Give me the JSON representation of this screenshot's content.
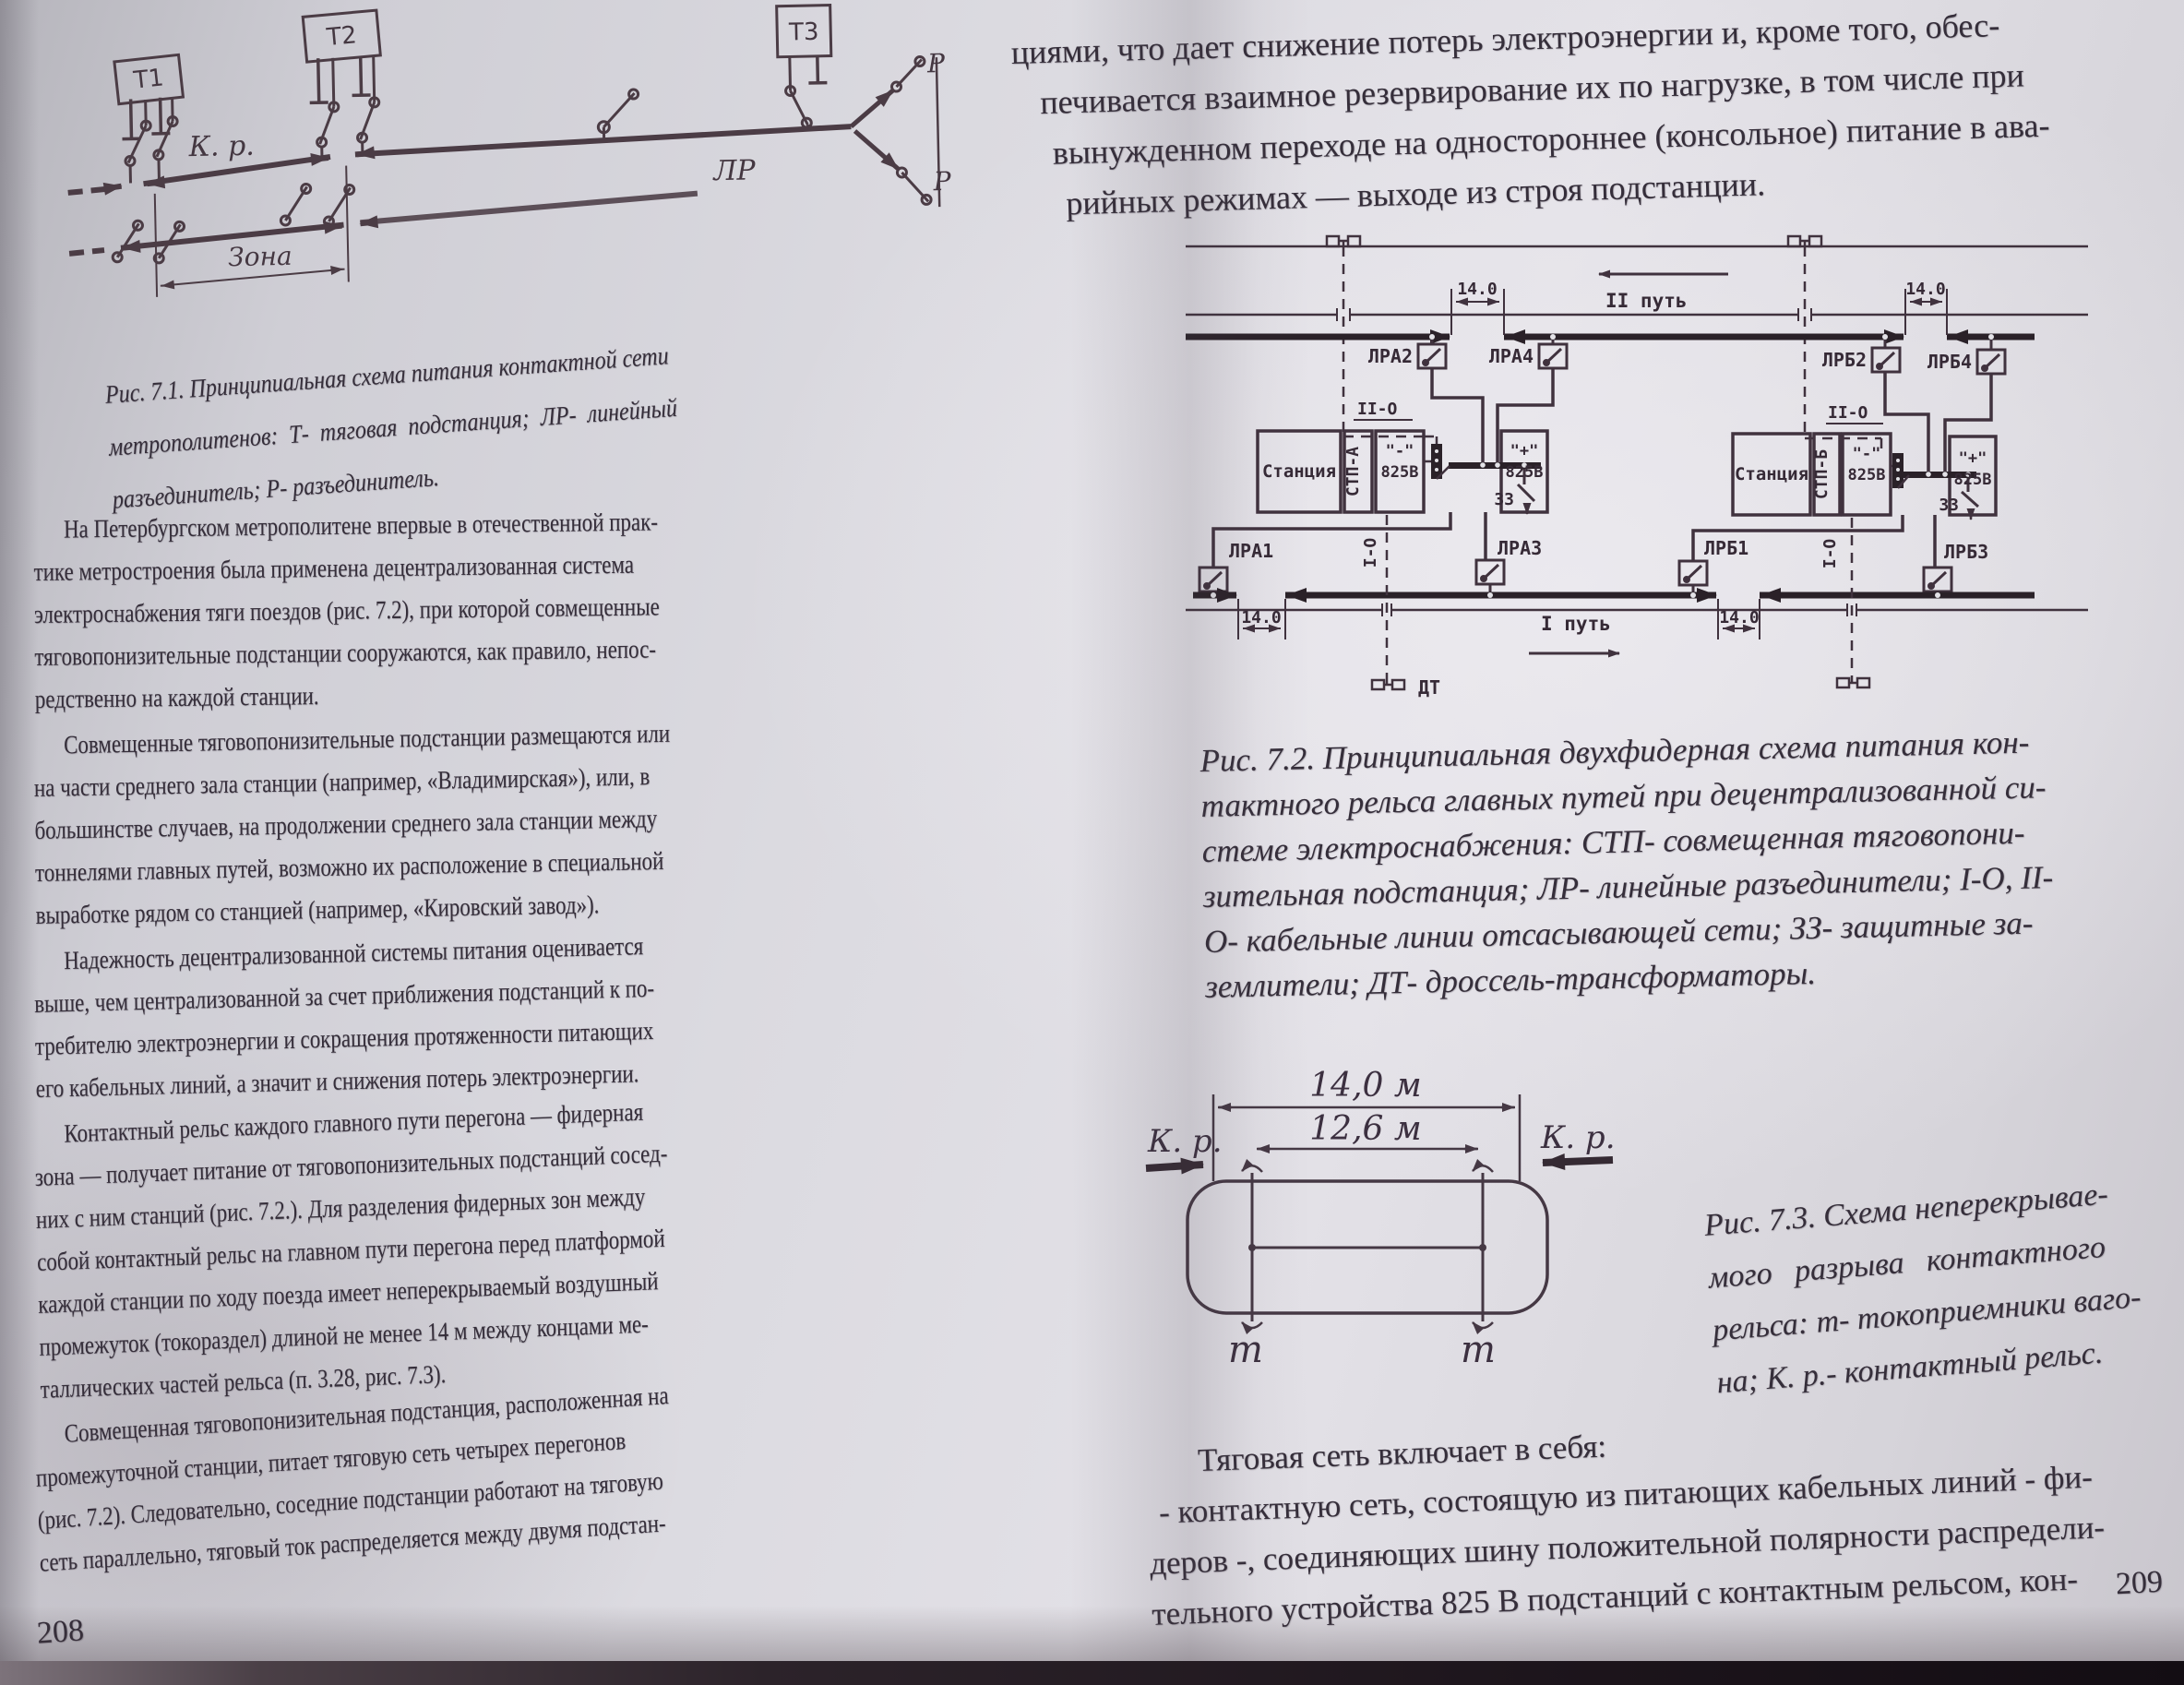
{
  "colors": {
    "paper": "#dbdae0",
    "ink": "#352e3a",
    "figure_ink": "#40323e"
  },
  "book": {
    "left_page": {
      "page_number": "208",
      "fig71": {
        "labels": {
          "t1": "Т1",
          "t2": "Т2",
          "t3": "Т3",
          "kr": "К. р.",
          "lr": "ЛР",
          "r": "Р",
          "zona": "Зона"
        },
        "caption_lines": [
          "Рис. 7.1. Принципиальная схема питания контактной сети",
          "метрополитенов: Т- тяговая подстанция; ЛР- линейный",
          "разъединитель; Р- разъединитель."
        ]
      },
      "paragraphs": [
        {
          "lines": [
            "На Петербургском метрополитене впервые в отечественной прак-",
            "тике метростроения была применена децентрализованная система",
            "электроснабжения тяги поездов (рис. 7.2), при которой совмещенные",
            "тяговопонизительные подстанции сооружаются, как правило, непос-",
            "редственно на каждой станции."
          ]
        },
        {
          "lines": [
            "Совмещенные тяговопонизительные подстанции размещаются или",
            "на части среднего зала станции (например, «Владимирская»), или, в",
            "большинстве случаев, на продолжении среднего зала станции между",
            "тоннелями главных путей, возможно их расположение в специальной",
            "выработке рядом со станцией (например, «Кировский завод»)."
          ]
        },
        {
          "lines": [
            "Надежность децентрализованной системы питания оценивается",
            "выше, чем централизованной за счет приближения подстанций к по-",
            "требителю электроэнергии и сокращения протяженности питающих",
            "его кабельных линий, а значит и снижения потерь электроэнергии."
          ]
        },
        {
          "lines": [
            "Контактный рельс каждого главного пути перегона — фидерная",
            "зона — получает питание от тяговопонизительных подстанций сосед-",
            "них с ним станций (рис. 7.2.). Для разделения фидерных зон между",
            "собой контактный рельс на главном пути перегона перед платформой",
            "каждой станции по ходу поезда имеет неперекрываемый воздушный",
            "промежуток (токораздел) длиной не менее 14 м между концами ме-",
            "таллических частей рельса (п. 3.28, рис. 7.3)."
          ]
        },
        {
          "lines": [
            "Совмещенная тяговопонизительная подстанция, расположенная на",
            "промежуточной станции, питает тяговую сеть четырех перегонов",
            "(рис. 7.2). Следовательно, соседние подстанции работают на тяговую",
            "сеть параллельно, тяговый ток распределяется между двумя подстан-"
          ]
        }
      ]
    },
    "right_page": {
      "page_number": "209",
      "top_paragraph_lines": [
        "циями, что дает снижение потерь электроэнергии и, кроме того, обес-",
        "печивается взаимное резервирование их по нагрузке, в том числе при",
        "вынужденном переходе на одностороннее (консольное) питание в ава-",
        "рийных режимах — выходе из строя подстанции."
      ],
      "fig72": {
        "labels": {
          "track2": "II путь",
          "track1": "I путь",
          "dim": "14.0",
          "lra1": "ЛРА1",
          "lra2": "ЛРА2",
          "lra3": "ЛРА3",
          "lra4": "ЛРА4",
          "lrb1": "ЛРБ1",
          "lrb2": "ЛРБ2",
          "lrb3": "ЛРБ3",
          "lrb4": "ЛРБ4",
          "station": "Станция",
          "stp_a": "СТП-А",
          "stp_b": "СТП-Б",
          "minus": "\"-\"",
          "plus": "\"+\"",
          "volts": "825В",
          "zz": "ЗЗ",
          "feeder1": "I-О",
          "feeder2": "II-О",
          "dt": "ДТ"
        },
        "caption_lines": [
          "Рис. 7.2. Принципиальная двухфидерная схема питания кон-",
          "тактного рельса главных путей при децентрализованной си-",
          "стеме электроснабжения:  СТП- совмещенная тяговопони-",
          "зительная подстанция;  ЛР- линейные разъединители; I-О, II-",
          "О- кабельные линии отсасывающей сети; ЗЗ- защитные за-",
          "землители; ДТ- дроссель-трансформаторы."
        ]
      },
      "fig73": {
        "labels": {
          "dim_outer": "14,0 м",
          "dim_inner": "12,6 м",
          "kr": "К. р.",
          "m": "m"
        },
        "caption_lines": [
          "Рис. 7.3. Схема неперекрывае-",
          "мого разрыва контактного",
          "рельса: т- токоприемники ваго-",
          "на; К. р.- контактный рельс."
        ]
      },
      "traction_intro": "Тяговая сеть включает в себя:",
      "bottom_paragraph_lines": [
        "- контактную сеть, состоящую из питающих кабельных линий - фи-",
        "деров -, соединяющих шину положительной полярности распредели-",
        "тельного устройства 825 В подстанций с контактным рельсом, кон-"
      ]
    }
  }
}
